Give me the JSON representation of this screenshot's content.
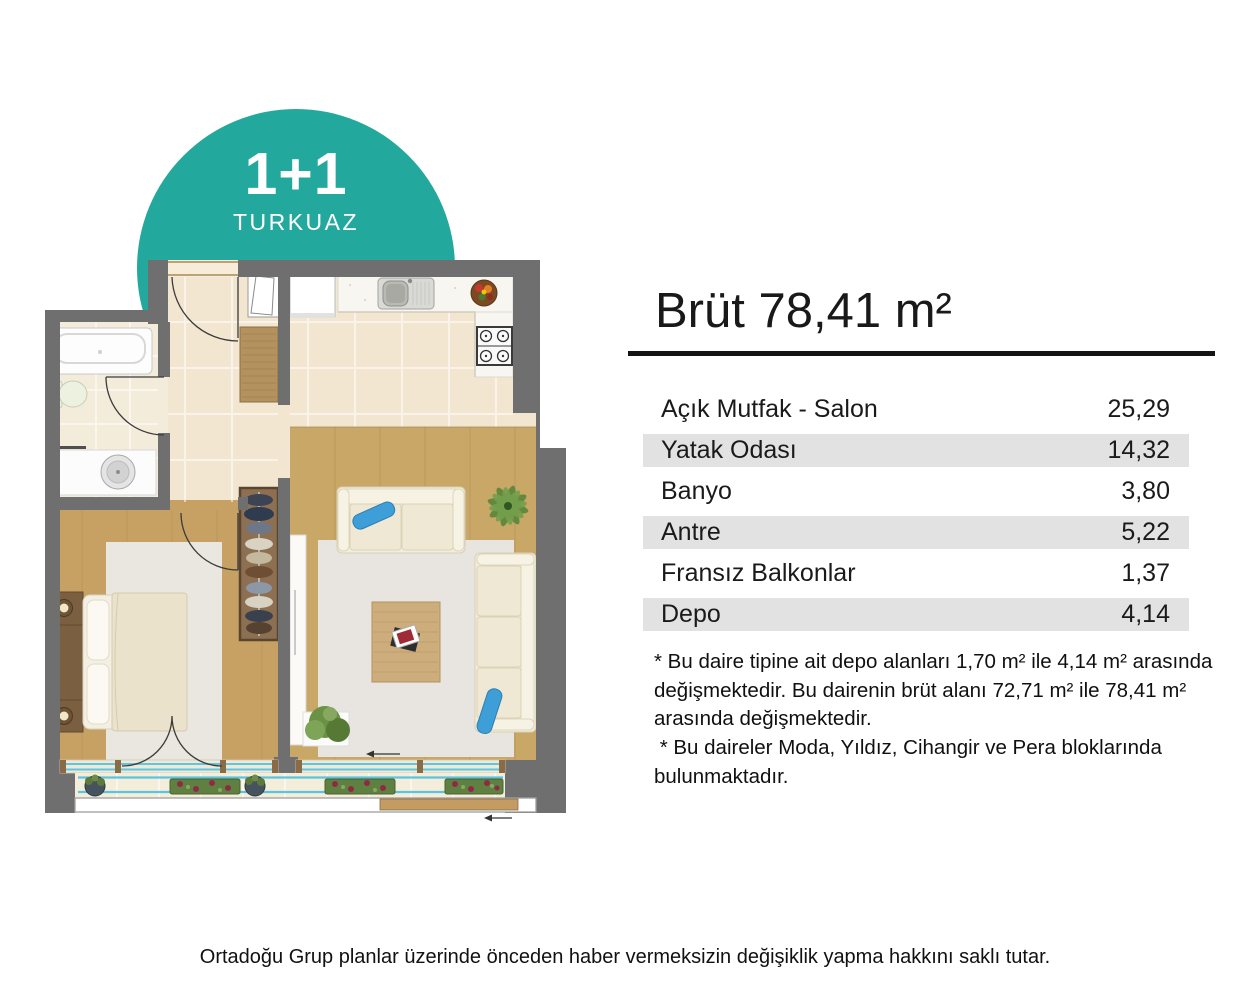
{
  "badge": {
    "type_label": "1+1",
    "name_label": "TURKUAZ",
    "color": "#23a89d"
  },
  "panel": {
    "title": "Brüt 78,41 m²",
    "rows": [
      {
        "label": "Açık Mutfak - Salon",
        "value": "25,29"
      },
      {
        "label": "Yatak Odası",
        "value": "14,32"
      },
      {
        "label": "Banyo",
        "value": "3,80"
      },
      {
        "label": "Antre",
        "value": "5,22"
      },
      {
        "label": "Fransız Balkonlar",
        "value": "1,37"
      },
      {
        "label": "Depo",
        "value": "4,14"
      }
    ],
    "footnote": "* Bu daire tipine ait depo alanları 1,70 m² ile 4,14 m² arasında\ndeğişmektedir. Bu dairenin brüt alanı 72,71 m² ile 78,41 m²\narasında değişmektedir.\n * Bu daireler Moda, Yıldız, Cihangir ve Pera bloklarında\nbulunmaktadır."
  },
  "footer": {
    "disclaimer": "Ortadoğu Grup planlar üzerinde önceden haber vermeksizin değişiklik yapma hakkını saklı tutar."
  },
  "colors": {
    "accent_teal": "#23a89d",
    "row_stripe": "#e2e2e2",
    "wall_gray": "#6f6f6f",
    "tile_cream": "#f2e6d0",
    "wood_tan": "#c7a466",
    "glass_blue": "#55c3e3",
    "cushion_blue": "#3d9ed8"
  }
}
